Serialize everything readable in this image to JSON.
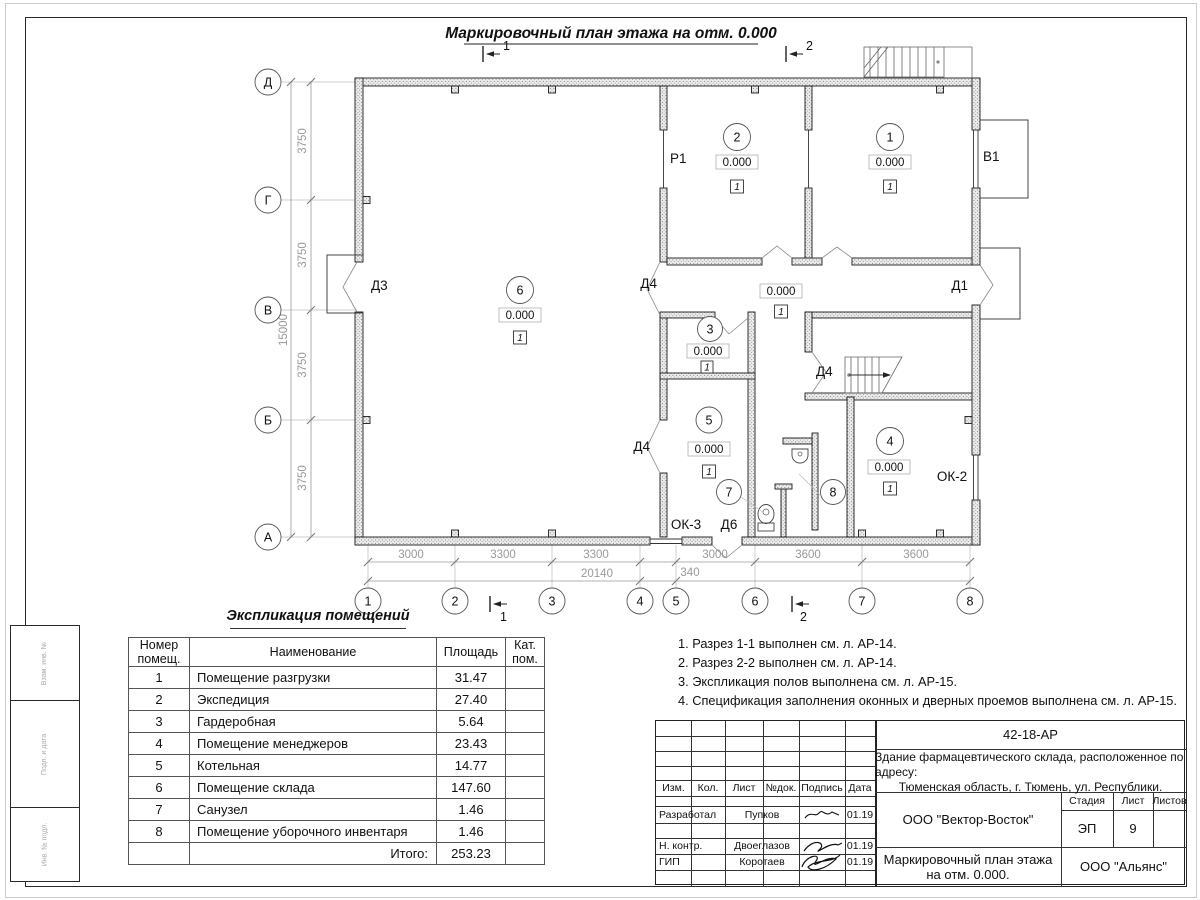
{
  "sheet": {
    "plan_title": "Маркировочный план этажа на отм. 0.000"
  },
  "plan": {
    "grid_rows": [
      "Д",
      "Г",
      "В",
      "Б",
      "А"
    ],
    "grid_cols": [
      "1",
      "2",
      "3",
      "4",
      "5",
      "6",
      "7",
      "8"
    ],
    "dims_left": [
      "3750",
      "3750",
      "3750",
      "3750"
    ],
    "total_left": "15000",
    "dims_bottom": [
      "3000",
      "3300",
      "3300",
      "3000",
      "3600",
      "3600"
    ],
    "total_bottom": "20140",
    "dim_340": "340",
    "section1": "1",
    "section2": "2",
    "openings": {
      "d1": "Д1",
      "d3": "Д3",
      "d4": "Д4",
      "d6": "Д6",
      "r1": "Р1",
      "v1": "В1",
      "ok2": "ОК-2",
      "ok3": "ОК-3"
    },
    "rooms": [
      {
        "num": "1",
        "level": "0.000",
        "floor": "1"
      },
      {
        "num": "2",
        "level": "0.000",
        "floor": "1"
      },
      {
        "num": "3",
        "level": "0.000",
        "floor": "1"
      },
      {
        "num": "4",
        "level": "0.000",
        "floor": "1"
      },
      {
        "num": "5",
        "level": "0.000",
        "floor": "1"
      },
      {
        "num": "6",
        "level": "0.000",
        "floor": "1"
      },
      {
        "num": "7"
      },
      {
        "num": "8"
      }
    ],
    "corridor": {
      "level": "0.000",
      "floor": "1"
    }
  },
  "expl": {
    "title": "Экспликация помещений",
    "headers": {
      "num": "Номер помещ.",
      "name": "Наименование",
      "area": "Площадь",
      "cat": "Кат. пом."
    },
    "rows": [
      {
        "num": "1",
        "name": "Помещение разгрузки",
        "area": "31.47"
      },
      {
        "num": "2",
        "name": "Экспедиция",
        "area": "27.40"
      },
      {
        "num": "3",
        "name": "Гардеробная",
        "area": "5.64"
      },
      {
        "num": "4",
        "name": "Помещение менеджеров",
        "area": "23.43"
      },
      {
        "num": "5",
        "name": "Котельная",
        "area": "14.77"
      },
      {
        "num": "6",
        "name": "Помещение склада",
        "area": "147.60"
      },
      {
        "num": "7",
        "name": "Санузел",
        "area": "1.46"
      },
      {
        "num": "8",
        "name": "Помещение уборочного инвентаря",
        "area": "1.46"
      }
    ],
    "total_label": "Итого:",
    "total_value": "253.23"
  },
  "notes": [
    "1. Разрез 1-1 выполнен см. л. АР-14.",
    "2. Разрез 2-2 выполнен см. л. АР-14.",
    "3. Экспликация полов выполнена см. л. АР-15.",
    "4. Спецификация заполнения оконных и дверных проемов выполнена см. л. АР-15."
  ],
  "titleblock": {
    "code": "42-18-АР",
    "object_line1": "Здание фармацевтического склада, расположенное по адресу:",
    "object_line2": "Тюменская область, г. Тюмень, ул. Республики.",
    "cols": {
      "izm": "Изм.",
      "kol": "Кол.",
      "list": "Лист",
      "ndok": "№док.",
      "podpis": "Подпись",
      "data": "Дата"
    },
    "rows": [
      {
        "role": "Разработал",
        "name": "Пупков",
        "date": "01.19"
      },
      {
        "role": "Н. контр.",
        "name": "Двоеглазов",
        "date": "01.19"
      },
      {
        "role": "ГИП",
        "name": "Коротаев",
        "date": "01.19"
      }
    ],
    "org": "ООО \"Вектор-Восток\"",
    "stage_label": "Стадия",
    "sheet_label": "Лист",
    "sheets_label": "Листов",
    "stage": "ЭП",
    "sheet_no": "9",
    "drawing_line1": "Маркировочный план этажа",
    "drawing_line2": "на отм. 0.000.",
    "customer": "ООО \"Альянс\""
  },
  "frame": {
    "side_labels": [
      "Взам. инв. №",
      "Подп. и дата",
      "Инв. № подл."
    ]
  }
}
